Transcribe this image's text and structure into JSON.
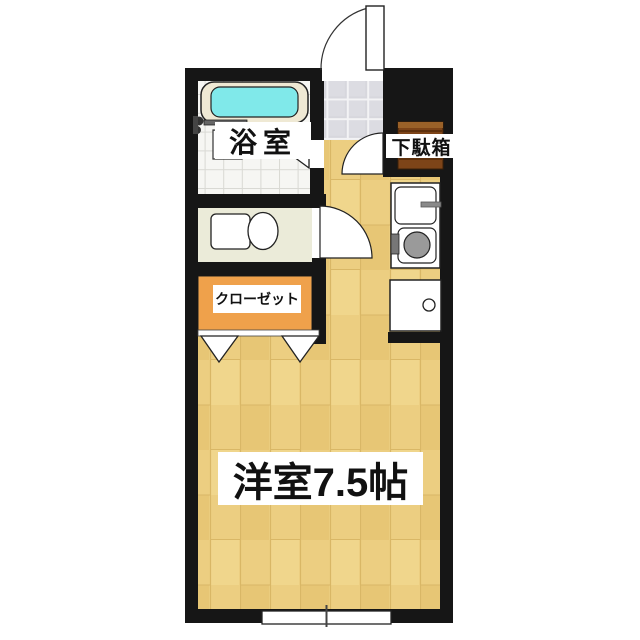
{
  "floorplan": {
    "type": "japanese-apartment-1K",
    "rooms": {
      "bathroom": {
        "label": "浴室"
      },
      "shoe_cabinet": {
        "label": "下駄箱"
      },
      "closet": {
        "label": "クローゼット"
      },
      "main_room": {
        "label": "洋室7.5帖"
      }
    },
    "fixtures": [
      "bathtub",
      "shower-faucet",
      "toilet",
      "kitchen-sink",
      "stove-burner",
      "kitchen-cabinet",
      "entrance-door",
      "hall-door",
      "toilet-door",
      "folding-bath-door",
      "closet-folding-door",
      "sliding-window",
      "entry-tile-floor"
    ],
    "colors": {
      "wall": "#161616",
      "wood_floor": "#ecce81",
      "closet_fill": "#efa14b",
      "bath_water": "#80e9ea",
      "tub_rim": "#efe9d4",
      "toilet_room_fill": "#ebebd9",
      "entry_tile": "#d8d8dd",
      "cabinet_wood": "#7d4418",
      "fixture_gray": "#9a9a9a",
      "label_bg": "#ffffff",
      "label_text": "#111111"
    }
  }
}
